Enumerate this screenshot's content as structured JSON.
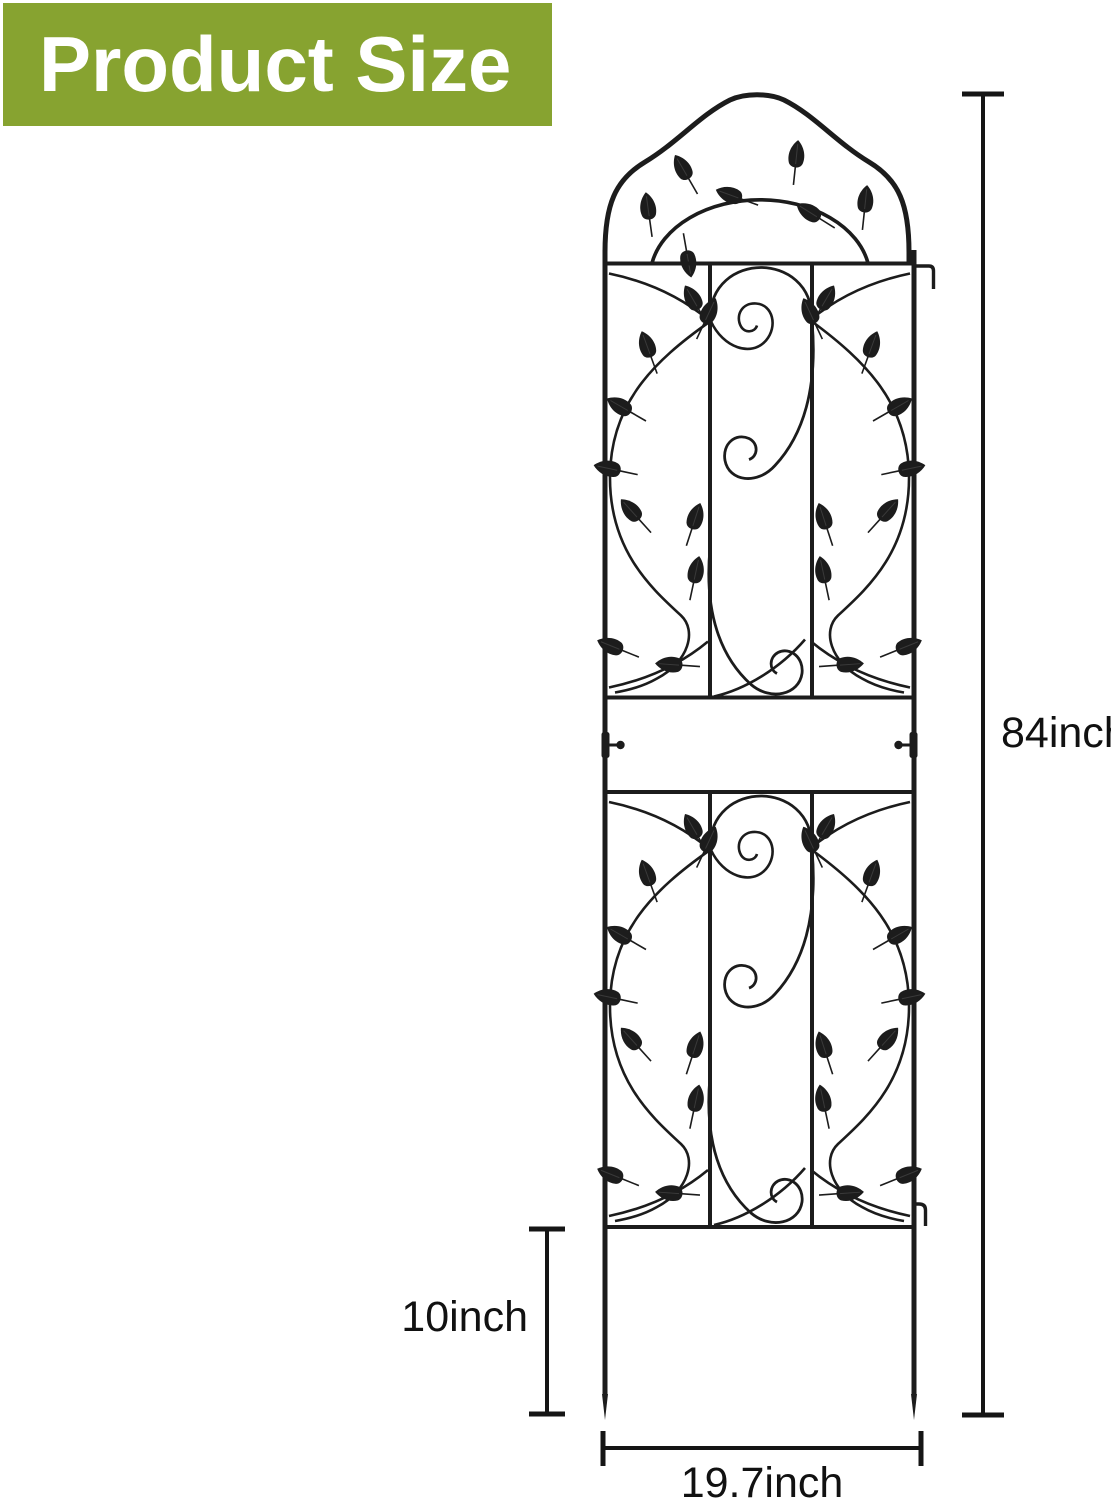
{
  "banner": {
    "title": "Product Size"
  },
  "colors": {
    "banner_bg": "#87a330",
    "banner_text": "#ffffff",
    "line": "#1c1c1c",
    "label_text": "#111111"
  },
  "product": {
    "type": "garden trellis",
    "style": "arched top with scroll and leaf ornaments, two panels, ground stakes"
  },
  "dimensions": {
    "total_height": {
      "label": "84inch",
      "value": 84,
      "unit": "inch"
    },
    "stake_height": {
      "label": "10inch",
      "value": 10,
      "unit": "inch"
    },
    "width": {
      "label": "19.7inch",
      "value": 19.7,
      "unit": "inch"
    }
  }
}
